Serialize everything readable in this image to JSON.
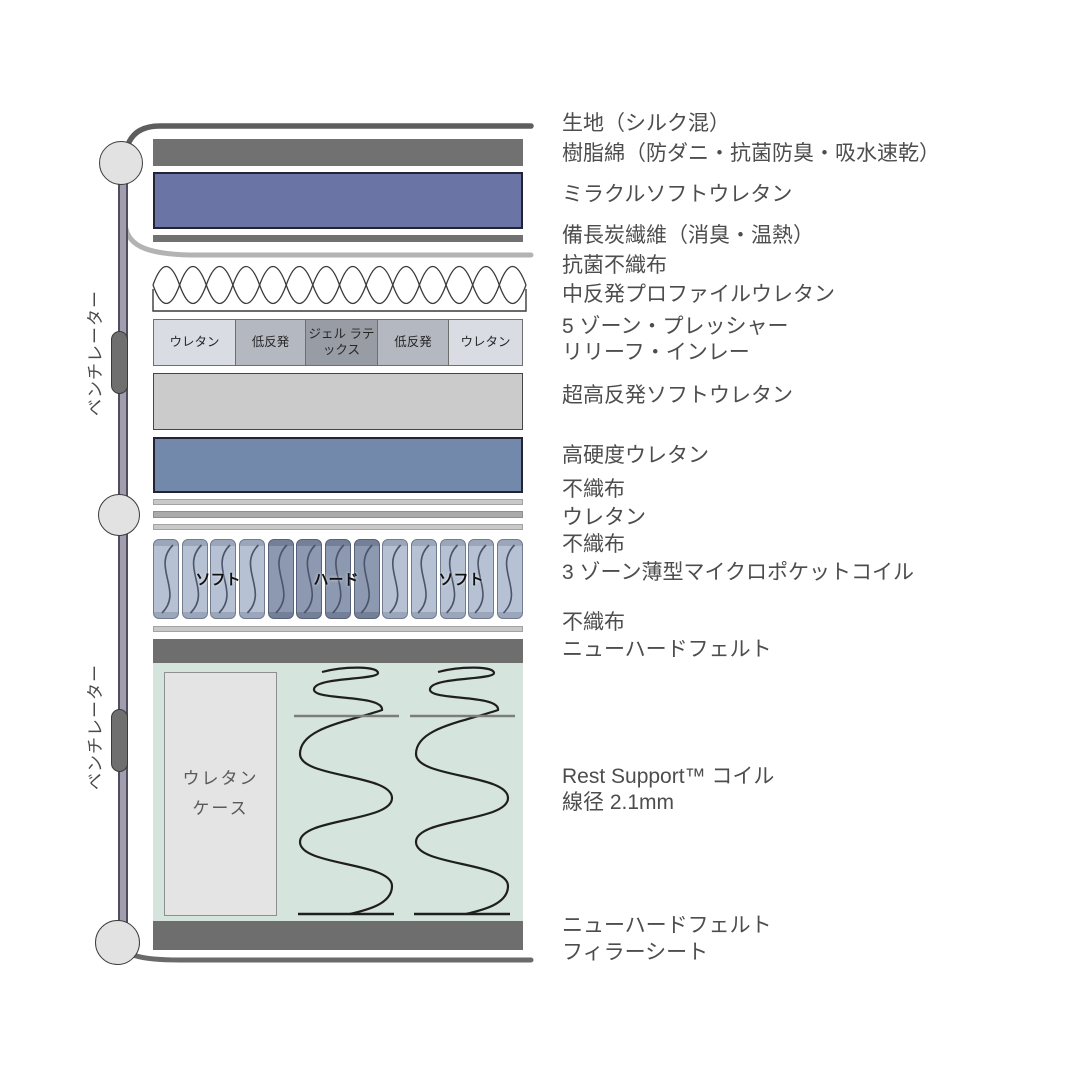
{
  "diagram": {
    "ventilator_label": "ベンチレーター",
    "zone5_cells": [
      "ウレタン",
      "低反発",
      "ジェル ラテックス",
      "低反発",
      "ウレタン"
    ],
    "coil_zone_labels": [
      "ソフト",
      "ハード",
      "ソフト"
    ],
    "urethane_case_label": "ウレタン\nケース"
  },
  "layers": {
    "fabric": "生地（シルク混）",
    "resin_cotton": "樹脂綿（防ダニ・抗菌防臭・吸水速乾）",
    "miracle_soft_urethane": "ミラクルソフトウレタン",
    "charcoal_fiber": "備長炭繊維（消臭・温熱）",
    "antibacterial_nonwoven": "抗菌不織布",
    "profile_urethane": "中反発プロファイルウレタン",
    "zone5_line1": "5 ゾーン・プレッシャー",
    "zone5_line2": "リリーフ・インレー",
    "super_high_resilience": "超高反発ソフトウレタン",
    "high_hardness_urethane": "高硬度ウレタン",
    "nonwoven_1": "不織布",
    "urethane": "ウレタン",
    "nonwoven_2": "不織布",
    "micro_pocket_coil": "3 ゾーン薄型マイクロポケットコイル",
    "nonwoven_3": "不織布",
    "new_hard_felt_top": "ニューハードフェルト",
    "rest_support_coil": "Rest Support™ コイル",
    "wire_diameter": "線径 2.1mm",
    "new_hard_felt_bottom": "ニューハードフェルト",
    "filler_sheet": "フィラーシート"
  },
  "colors": {
    "dark_bar": "#707070",
    "miracle_urethane": "#6a75a5",
    "high_hardness_urethane": "#7389ac",
    "super_high_resilience": "#cbcbcb",
    "thin_light_bar": "#c8c8c8",
    "thin_mid_bar": "#aaaaaa",
    "mint_background": "#d6e4de",
    "coil_light": "#b6c1d3",
    "coil_dark": "#8c99b0",
    "zone_urethane": "#d9dde3",
    "zone_low_resilience": "#b4b8c0",
    "zone_gel_latex": "#989ca4",
    "label_text": "#4d4d4d"
  }
}
